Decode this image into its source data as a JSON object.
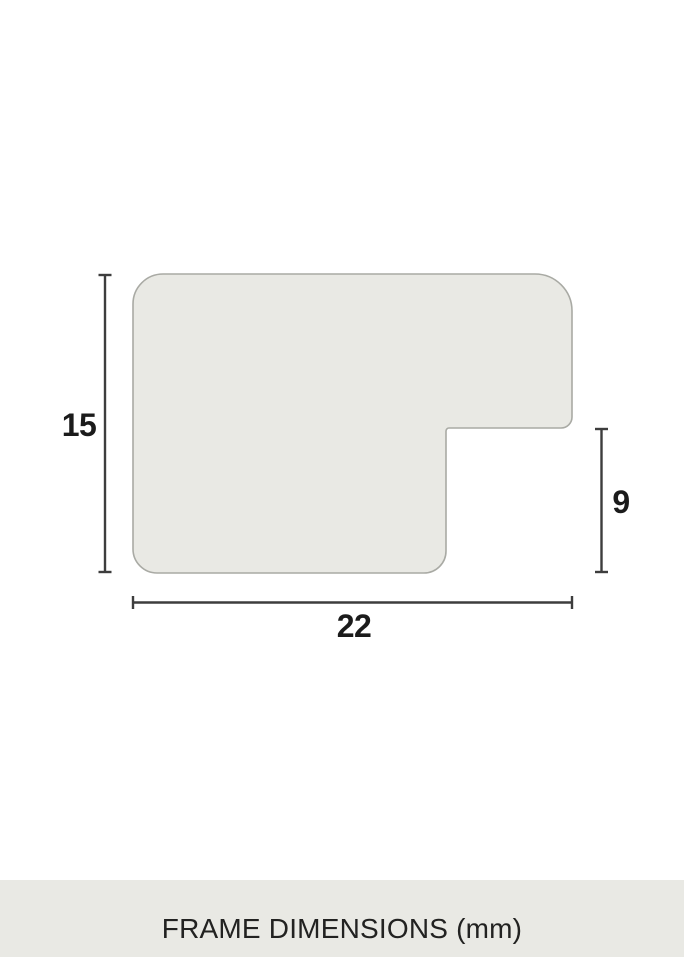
{
  "diagram": {
    "name": "frame-profile-cross-section",
    "unit": "mm",
    "dimensions": {
      "height": {
        "value": "15",
        "side": "left",
        "measures": "total profile height"
      },
      "rabbet": {
        "value": "9",
        "side": "right",
        "measures": "rabbet step height"
      },
      "width": {
        "value": "22",
        "side": "bottom",
        "measures": "total profile width"
      }
    }
  },
  "footer": {
    "caption": "FRAME DIMENSIONS (mm)"
  },
  "colors": {
    "background": "#ffffff",
    "profile_fill": "#e9e9e4",
    "profile_stroke": "#a9aaa4",
    "dimension_line": "#3d3d3d",
    "label_text": "#1b1b1b",
    "footer_background": "#e9e9e4",
    "footer_text": "#222221"
  }
}
